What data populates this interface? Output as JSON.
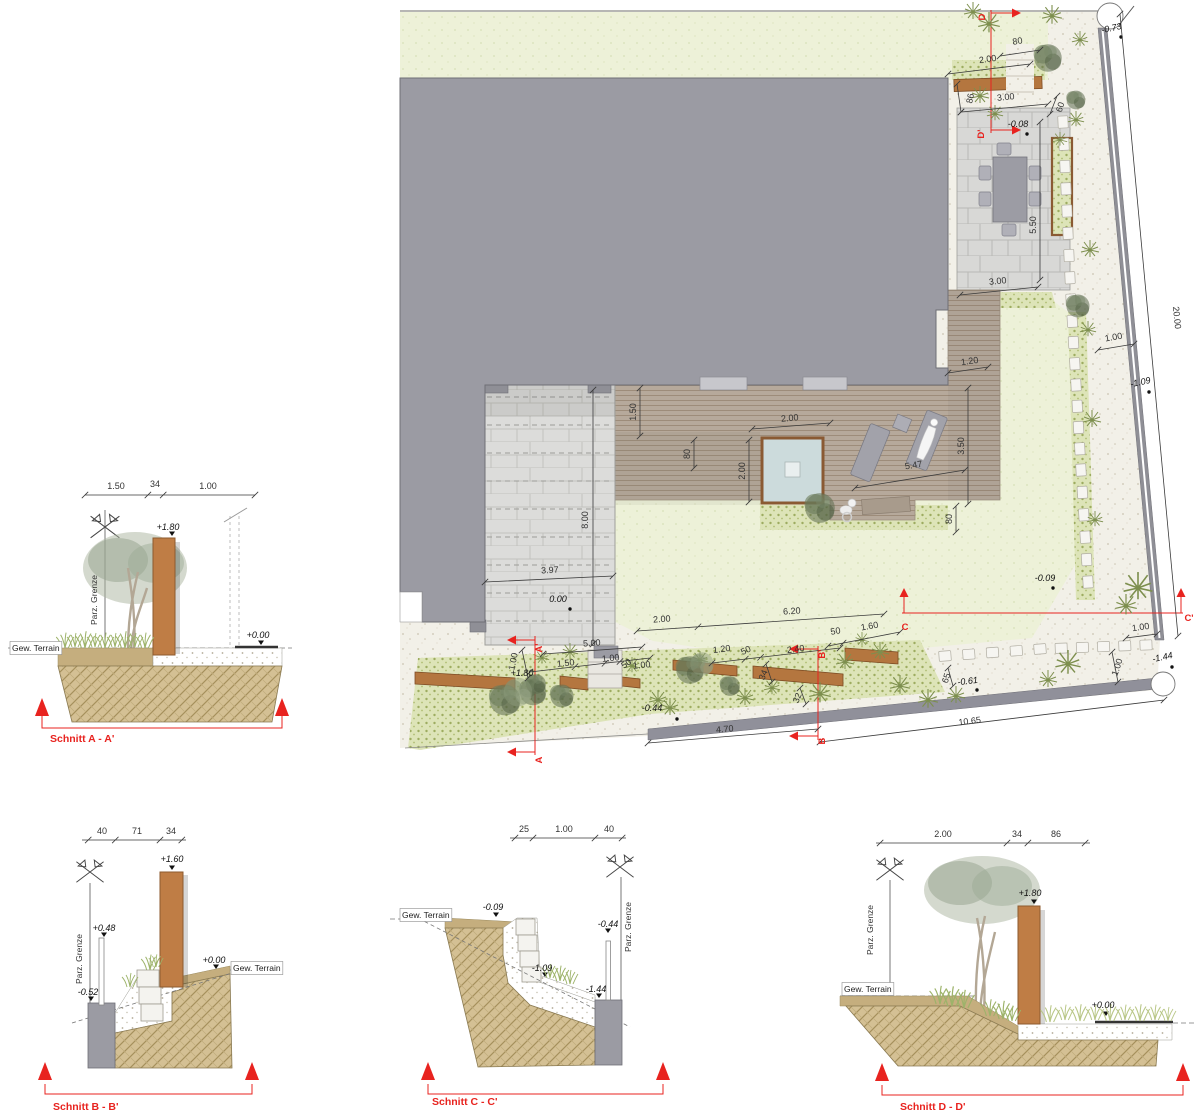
{
  "plan": {
    "labels": [
      {
        "t": "80",
        "x": 618,
        "y": 44,
        "r": -10,
        "c": "d"
      },
      {
        "t": "2.00",
        "x": 588,
        "y": 62,
        "r": -8,
        "c": "d"
      },
      {
        "t": "86",
        "x": 573,
        "y": 99,
        "r": -78,
        "c": "d"
      },
      {
        "t": "3.00",
        "x": 606,
        "y": 100,
        "r": -6,
        "c": "d"
      },
      {
        "t": "60",
        "x": 663,
        "y": 108,
        "r": -72,
        "c": "d"
      },
      {
        "t": "5.50",
        "x": 636,
        "y": 225,
        "r": -90,
        "c": "d"
      },
      {
        "t": "3.00",
        "x": 598,
        "y": 284,
        "r": -6,
        "c": "d"
      },
      {
        "t": "1.20",
        "x": 570,
        "y": 364,
        "r": -8,
        "c": "d"
      },
      {
        "t": "3.50",
        "x": 564,
        "y": 446,
        "r": -90,
        "c": "d"
      },
      {
        "t": "80",
        "x": 552,
        "y": 519,
        "r": -90,
        "c": "d"
      },
      {
        "t": "1.50",
        "x": 236,
        "y": 412,
        "r": -90,
        "c": "d"
      },
      {
        "t": "2.00",
        "x": 390,
        "y": 421,
        "r": -5,
        "c": "d"
      },
      {
        "t": "80",
        "x": 290,
        "y": 454,
        "r": -90,
        "c": "d"
      },
      {
        "t": "2.00",
        "x": 345,
        "y": 471,
        "r": -90,
        "c": "d"
      },
      {
        "t": "5.47",
        "x": 514,
        "y": 468,
        "r": -9,
        "c": "d"
      },
      {
        "t": "8.00",
        "x": 188,
        "y": 520,
        "r": -90,
        "c": "d"
      },
      {
        "t": "3.97",
        "x": 150,
        "y": 573,
        "r": -3,
        "c": "d"
      },
      {
        "t": "2.00",
        "x": 262,
        "y": 622,
        "r": -4,
        "c": "d"
      },
      {
        "t": "6.20",
        "x": 392,
        "y": 614,
        "r": -4,
        "c": "d"
      },
      {
        "t": "50",
        "x": 436,
        "y": 634,
        "r": -10,
        "c": "d"
      },
      {
        "t": "1.60",
        "x": 470,
        "y": 629,
        "r": -10,
        "c": "d"
      },
      {
        "t": "5.00",
        "x": 192,
        "y": 646,
        "r": -4,
        "c": "d"
      },
      {
        "t": "1.00",
        "x": 116,
        "y": 662,
        "r": -78,
        "c": "d"
      },
      {
        "t": "1.50",
        "x": 166,
        "y": 666,
        "r": -6,
        "c": "d"
      },
      {
        "t": "1.00",
        "x": 211,
        "y": 661,
        "r": -6,
        "c": "d"
      },
      {
        "t": "50",
        "x": 228,
        "y": 666,
        "r": -35,
        "c": "d"
      },
      {
        "t": "1.00",
        "x": 242,
        "y": 668,
        "r": -6,
        "c": "d"
      },
      {
        "t": "1.20",
        "x": 322,
        "y": 652,
        "r": -7,
        "c": "d"
      },
      {
        "t": "50",
        "x": 347,
        "y": 653,
        "r": -25,
        "c": "d"
      },
      {
        "t": "2.40",
        "x": 396,
        "y": 652,
        "r": -7,
        "c": "d"
      },
      {
        "t": "34",
        "x": 366,
        "y": 676,
        "r": -68,
        "c": "d"
      },
      {
        "t": "32",
        "x": 400,
        "y": 699,
        "r": -68,
        "c": "d"
      },
      {
        "t": "4.70",
        "x": 325,
        "y": 732,
        "r": -5,
        "c": "d"
      },
      {
        "t": "10.65",
        "x": 570,
        "y": 724,
        "r": -7,
        "c": "d"
      },
      {
        "t": "65",
        "x": 549,
        "y": 679,
        "r": -72,
        "c": "d"
      },
      {
        "t": "1.00",
        "x": 741,
        "y": 630,
        "r": -8,
        "c": "d"
      },
      {
        "t": "1.00",
        "x": 720,
        "y": 668,
        "r": -72,
        "c": "d"
      },
      {
        "t": "1.00",
        "x": 714,
        "y": 340,
        "r": -10,
        "c": "d"
      },
      {
        "t": "20.00",
        "x": 774,
        "y": 318,
        "r": 84,
        "c": "d"
      },
      {
        "t": "-0.73",
        "x": 712,
        "y": 31,
        "r": -12,
        "c": "e"
      },
      {
        "t": "-0.08",
        "x": 618,
        "y": 127,
        "c": "e"
      },
      {
        "t": "-1.09",
        "x": 741,
        "y": 385,
        "r": -12,
        "c": "e"
      },
      {
        "t": "-0.09",
        "x": 645,
        "y": 581,
        "c": "e"
      },
      {
        "t": "0.00",
        "x": 158,
        "y": 602,
        "c": "e"
      },
      {
        "t": "+1.80",
        "x": 122,
        "y": 676,
        "c": "e"
      },
      {
        "t": "-0.44",
        "x": 252,
        "y": 711,
        "c": "e"
      },
      {
        "t": "-0.61",
        "x": 568,
        "y": 684,
        "r": -7,
        "c": "e"
      },
      {
        "t": "-1.44",
        "x": 763,
        "y": 660,
        "r": -12,
        "c": "e"
      },
      {
        "t": "D",
        "x": 585,
        "y": 17,
        "r": -90,
        "c": "r"
      },
      {
        "t": "D'",
        "x": 584,
        "y": 134,
        "r": -90,
        "c": "r"
      },
      {
        "t": "A'",
        "x": 142,
        "y": 648,
        "r": -90,
        "c": "r"
      },
      {
        "t": "A",
        "x": 142,
        "y": 760,
        "r": -90,
        "c": "r"
      },
      {
        "t": "B'",
        "x": 425,
        "y": 654,
        "r": -90,
        "c": "r"
      },
      {
        "t": "B",
        "x": 425,
        "y": 741,
        "r": -90,
        "c": "r"
      },
      {
        "t": "C",
        "x": 505,
        "y": 630,
        "c": "r"
      },
      {
        "t": "C'",
        "x": 789,
        "y": 621,
        "c": "r"
      }
    ]
  },
  "section_a": {
    "labels": [
      {
        "t": "1.50",
        "x": 96,
        "y": 19,
        "c": "d"
      },
      {
        "t": "34",
        "x": 135,
        "y": 17,
        "c": "d"
      },
      {
        "t": "1.00",
        "x": 188,
        "y": 19,
        "c": "d"
      },
      {
        "t": "+1.80",
        "x": 148,
        "y": 60,
        "c": "e"
      },
      {
        "t": "+0.00",
        "x": 238,
        "y": 168,
        "c": "e"
      },
      {
        "t": "Gew. Terrain",
        "x": -8,
        "y": 181,
        "c": "box"
      },
      {
        "t": "Parz. Grenze",
        "x": 77,
        "y": 130,
        "r": -90,
        "c": "rot"
      },
      {
        "t": "Schnitt A - A'",
        "x": 30,
        "y": 272,
        "c": "title"
      }
    ]
  },
  "section_b": {
    "labels": [
      {
        "t": "40",
        "x": 82,
        "y": 19,
        "c": "d"
      },
      {
        "t": "71",
        "x": 117,
        "y": 19,
        "c": "d"
      },
      {
        "t": "34",
        "x": 151,
        "y": 19,
        "c": "d"
      },
      {
        "t": "+1.60",
        "x": 152,
        "y": 47,
        "c": "e"
      },
      {
        "t": "+0.48",
        "x": 84,
        "y": 116,
        "c": "e"
      },
      {
        "t": "-0.52",
        "x": 68,
        "y": 180,
        "c": "e"
      },
      {
        "t": "+0.00",
        "x": 194,
        "y": 148,
        "c": "e"
      },
      {
        "t": "Gew. Terrain",
        "x": 213,
        "y": 156,
        "c": "box"
      },
      {
        "t": "Parz. Grenze",
        "x": 62,
        "y": 144,
        "r": -90,
        "c": "rot"
      },
      {
        "t": "Schnitt B - B'",
        "x": 33,
        "y": 295,
        "c": "title"
      }
    ]
  },
  "section_c": {
    "labels": [
      {
        "t": "25",
        "x": 134,
        "y": 17,
        "c": "d"
      },
      {
        "t": "1.00",
        "x": 174,
        "y": 17,
        "c": "d"
      },
      {
        "t": "40",
        "x": 219,
        "y": 17,
        "c": "d"
      },
      {
        "t": "-0.09",
        "x": 103,
        "y": 95,
        "c": "e"
      },
      {
        "t": "-0.44",
        "x": 218,
        "y": 112,
        "c": "e"
      },
      {
        "t": "-1.09",
        "x": 152,
        "y": 156,
        "c": "e"
      },
      {
        "t": "-1.44",
        "x": 206,
        "y": 177,
        "c": "e"
      },
      {
        "t": "Gew. Terrain",
        "x": 12,
        "y": 103,
        "c": "box"
      },
      {
        "t": "Parz. Grenze",
        "x": 241,
        "y": 112,
        "r": -90,
        "c": "rot"
      },
      {
        "t": "Schnitt C - C'",
        "x": 42,
        "y": 290,
        "c": "title"
      }
    ]
  },
  "section_d": {
    "labels": [
      {
        "t": "2.00",
        "x": 103,
        "y": 17,
        "c": "d"
      },
      {
        "t": "34",
        "x": 177,
        "y": 17,
        "c": "d"
      },
      {
        "t": "86",
        "x": 216,
        "y": 17,
        "c": "d"
      },
      {
        "t": "+1.80",
        "x": 190,
        "y": 76,
        "c": "e"
      },
      {
        "t": "+0.00",
        "x": 263,
        "y": 188,
        "c": "e"
      },
      {
        "t": "Gew. Terrain",
        "x": 4,
        "y": 172,
        "c": "box"
      },
      {
        "t": "Parz. Grenze",
        "x": 33,
        "y": 110,
        "r": -90,
        "c": "rot"
      },
      {
        "t": "Schnitt D - D'",
        "x": 60,
        "y": 290,
        "c": "title"
      }
    ]
  },
  "colors": {
    "section_marker_red": "#e8231f",
    "corten_brown": "#bf7d45",
    "building_gray": "#9b9ba3",
    "lawn_green": "#edf1d8",
    "soil_tan": "#d4c094",
    "water_blue": "#ccdbdc"
  }
}
